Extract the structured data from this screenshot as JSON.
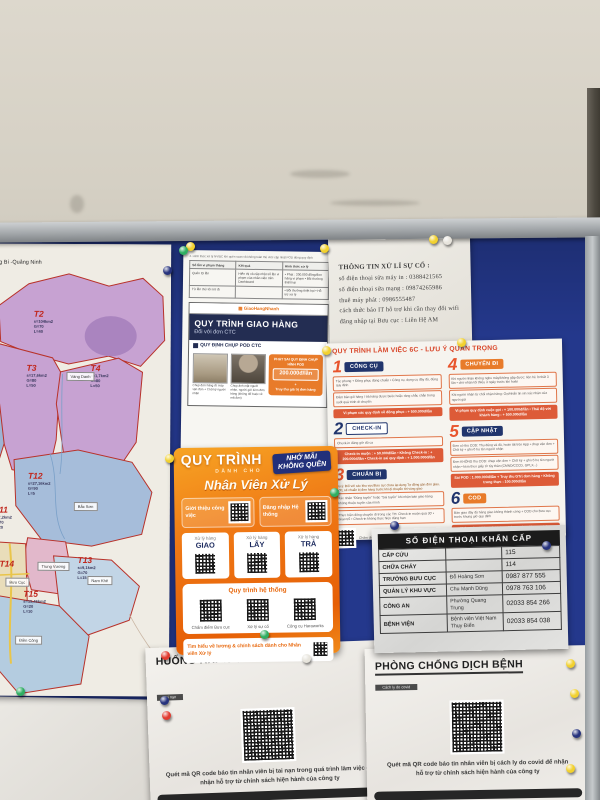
{
  "colors": {
    "board_blue": "#24388c",
    "wall": "#d8d3c8",
    "frame": "#b3b6b9",
    "poster_orange": "#ef7815",
    "navy": "#21356d",
    "penalty_red": "#dd5b38",
    "black_bar": "#1b1b1b"
  },
  "map": {
    "title": "ông Bí -Quảng Ninh",
    "regions": [
      {
        "name": "T2",
        "stats": [
          "s=104km2",
          "G=70",
          "L=40"
        ],
        "x": 43,
        "y": 66
      },
      {
        "name": "T3",
        "stats": [
          "s=17,6km2",
          "G=80",
          "L=50"
        ],
        "x": 36,
        "y": 120
      },
      {
        "name": "T4",
        "stats": [
          "s=1,7km2",
          "G=80",
          "L=50"
        ],
        "x": 100,
        "y": 120
      },
      {
        "name": "T12",
        "stats": [
          "s=27,16km2",
          "G=90",
          "L=5"
        ],
        "x": 38,
        "y": 228
      },
      {
        "name": "T11",
        "stats": [
          "s=7,2km2",
          "G=70",
          "L=20"
        ],
        "x": 4,
        "y": 262
      },
      {
        "name": "T14",
        "stats": [],
        "x": 10,
        "y": 316
      },
      {
        "name": "T13",
        "stats": [
          "s=9,1km2",
          "G=70",
          "L=15"
        ],
        "x": 88,
        "y": 312
      },
      {
        "name": "T15",
        "stats": [
          "s=15,46km2",
          "G=20",
          "L=10"
        ],
        "x": 34,
        "y": 346
      }
    ],
    "places": [
      {
        "name": "Vàng Danh",
        "x": 76,
        "y": 128
      },
      {
        "name": "Bắc Sơn",
        "x": 84,
        "y": 258
      },
      {
        "name": "Trung Vương",
        "x": 48,
        "y": 318
      },
      {
        "name": "Nam Khê",
        "x": 98,
        "y": 332
      },
      {
        "name": "Bưu Cục",
        "x": 16,
        "y": 334
      },
      {
        "name": "Điền Công",
        "x": 26,
        "y": 392
      }
    ]
  },
  "giao_hang": {
    "top_note": "4. Hình thức xử lý NV/BC khi quên scan và không tuân thủ việc cập nhật POD đúng quy định",
    "table": {
      "headers": [
        "Số lần vi phạm tháng",
        "Kết quả",
        "Hình thức xử lý"
      ],
      "rows": [
        [
          "Quên ID lần",
          "Hiển thị và cập nhật số lần vi phạm của nhân viên trên Dashboard",
          "• Phạt : 200.000 đồng/đơn hàng vi phạm • Bồi thường thiệt hại"
        ],
        [
          "Từ lần thứ tới trở đi",
          "",
          "• Bồi thường thiệt hại • Hỗ trợ xử lý"
        ]
      ]
    },
    "logo": "GiaoHangNhanh",
    "header_title": "QUY TRÌNH GIAO HÀNG",
    "header_sub": "Đối với đơn CTC",
    "section_title": "QUY ĐỊNH CHỤP POD CTC",
    "photo1_caption": "Chụp đơn hàng đi: Hộp vận đơn + Chữ ký người nhận",
    "photo2_caption": "Chụp ảnh mặt người nhận, người gửi kèm đơn hàng (không để buộc về mã đơn)",
    "fine_title": "PHẠT SAI QUY ĐỊNH CHỤP HÌNH POD",
    "fine_amount": "200.000đ/lần",
    "fine_plus": "+",
    "fine_extra": "Truy thu giá trị đơn hàng"
  },
  "su_co": {
    "lines": [
      "THÔNG TIN XỬ LÍ SỰ CỐ :",
      "số điện thoại sửa máy in : 0388421565",
      "số điện thoại sửa mạng : 09874265986",
      "thuê máy phát : 0986555487",
      "cách thức báo IT hỗ trợ khi cần thay đổi wifi",
      "đăng nhập tại Bưu cục : Liên Hệ AM"
    ]
  },
  "sixc": {
    "title": "QUY TRÌNH LÀM VIỆC 6C - LƯU Ý QUAN TRỌNG",
    "columns": [
      [
        {
          "num": "1",
          "num_color": "#e8542c",
          "label": "CÔNG CỤ",
          "label_bg": "#21356d",
          "label_color": "#ffffff",
          "boxes": [
            "Tác phong + Đồng phục đúng chuẩn • Công cụ, dụng cụ đầy đủ, đúng quy định",
            "Đảm bảo gói hàng / trả hàng được buộc hoặc ràng chắc chắn trong suốt quá trình di chuyển"
          ],
          "penalty": "Vi phạm các quy định về đồng phục : + 500.000đ/lần"
        },
        {
          "num": "2",
          "num_color": "#21356d",
          "label": "CHECK-IN",
          "label_bg": "#ffffff",
          "label_color": "#21356d",
          "boxes": [
            "Check-in đúng giờ đủ ca"
          ],
          "penalty": "Check-in muộn : + 50.000đ/lần • Không Check-in : + 200.000đ/lần • Check-in sai quy định : + 1.000.000đ/lần"
        },
        {
          "num": "3",
          "num_color": "#e8542c",
          "label": "CHUẨN BỊ",
          "label_bg": "#21356d",
          "label_color": "#ffffff",
          "note": "Lưu ý: Đối với các khu vực/Bưu cục chưa áp dụng Tự động gán đơn giao, NVXL sẽ chuẩn bị đơn hàng trước khi di chuyển tới vùng giao",
          "boxes": [
            "Xác nhận \"Đúng tuyến\" hoặc \"Sai tuyến\" khi nhận bàn giao hàng không thuộc tuyến của mình",
            "Thực hiện đóng chuyến đi trong các TH: Check-in muộn quá 30' • Giao trễ • Check-in không thực hiện đúng hạn"
          ],
          "penalty": null
        }
      ],
      [
        {
          "num": "4",
          "num_color": "#e8542c",
          "label": "CHUYỂN ĐI",
          "label_bg": "#e87b2a",
          "label_color": "#ffffff",
          "boxes": [
            "Khi người nhận không nghe máy/không gặp được: liên hệ ít nhất 3 lần • chờ nhận tối thiểu 3 ngày trước khi hoàn",
            "Khi người nhận từ chối nhận hàng: Gọi/nhắn tin xin xác nhận của người gửi"
          ],
          "penalty": "Vi phạm quy định cuộc gọi : + 100.000đ/lần • Thái độ với khách hàng : + 500.000đ/lần"
        },
        {
          "num": "5",
          "num_color": "#e8542c",
          "label": "CẬP NHẬT",
          "label_bg": "#21356d",
          "label_color": "#ffffff",
          "boxes": [
            "Đơn có thu COD: Thu đúng và đủ, hoàn tất trên App • chụp vận đơn + Chữ ký + ghi rõ họ tên người nhận",
            "Đơn KHÔNG thu COD: chụp vận đơn + Chữ ký + ghi rõ họ tên người nhận • kèm theo giấy tờ tùy thân (CMND/CCCD, GPLX...)"
          ],
          "penalty": "Sai POD : 1.000.000đ/lần + Truy thu GTrị đơn hàng • Không trung thực : 100.000đ/lần"
        },
        {
          "num": "6",
          "num_color": "#21356d",
          "label": "COD",
          "label_bg": "#e87b2a",
          "label_color": "#ffffff",
          "boxes": [
            "Bàn giao đầy đủ hàng giao không thành công + COD cho Bưu cục trước khung giờ quy định"
          ],
          "penalty": "Chậm nộp COD : Xử lý theo Nội quy lao động • Không nộp/chiếm dụng COD : Xử lý hình sự theo luật pháp"
        }
      ]
    ],
    "qr_caption": "Chấm điểm chất lượng dịch vụ Bưu cục và nhân viên",
    "footer": "Designed by Lưu Thanh - Văn Dung"
  },
  "poster": {
    "title": "QUY TRÌNH",
    "subtitle": "DÀNH CHO",
    "badge_line1": "NHỚ MÃI",
    "badge_line2": "KHÔNG QUÊN",
    "name": "Nhân Viên Xử Lý",
    "intro_boxes": [
      "Giới thiệu công việc",
      "Đăng nhập Hệ thống"
    ],
    "handle_boxes": [
      {
        "pre": "Xử lý hàng",
        "main": "GIAO"
      },
      {
        "pre": "Xử lý hàng",
        "main": "LẤY"
      },
      {
        "pre": "Xử lý hàng",
        "main": "TRẢ"
      }
    ],
    "panel_title": "Quy trình hệ thống",
    "panel_items": [
      "Chấm điểm Bưu cục",
      "Xử lý sự cố",
      "Công cụ Haraworks"
    ],
    "footer_text": "Tìm hiểu về lương & chính sách dành cho Nhân viên Xử lý"
  },
  "phone": {
    "title": "SỐ ĐIỆN THOẠI KHẨN CẤP",
    "rows": [
      [
        "CẤP CỨU",
        "",
        "115"
      ],
      [
        "CHỮA CHÁY",
        "",
        "114"
      ],
      [
        "TRƯỞNG BƯU CỤC",
        "Đỗ Hoàng Sơn",
        "0987 877 555"
      ],
      [
        "QUẢN LÝ KHU VỰC",
        "Chu Mạnh Dũng",
        "0978 763 106"
      ],
      [
        "CÔNG AN",
        "Phường Quang Trung",
        "02033 854 266"
      ],
      [
        "BỆNH VIỆN",
        "Bệnh viện Việt Nam Thụy Điển",
        "02033 854 038"
      ]
    ]
  },
  "emergency": {
    "title": "HUỐNG KHẨN CẤP",
    "tag": "Tai nạn",
    "caption": "Quét mã QR code báo tin nhân viên bị tai nạn trong quá trình làm việc để nhận hỗ trợ từ chính sách hiện hành của công ty"
  },
  "covid": {
    "title": "PHÒNG CHỐNG DỊCH BỆNH",
    "tag": "Cách ly do covid",
    "caption": "Quét mã QR code báo tin nhân viên bị cách ly do covid để nhận hỗ trợ từ chính sách hiện hành của công ty"
  },
  "pins": [
    {
      "color": "#f2d12e",
      "x": 186,
      "y": 242
    },
    {
      "color": "#2fae62",
      "x": 179,
      "y": 246
    },
    {
      "color": "#27337d",
      "x": 163,
      "y": 266
    },
    {
      "color": "#f2d12e",
      "x": 320,
      "y": 244
    },
    {
      "color": "#f2d12e",
      "x": 429,
      "y": 235
    },
    {
      "color": "#e7e4dc",
      "x": 443,
      "y": 236
    },
    {
      "color": "#f2d12e",
      "x": 457,
      "y": 338
    },
    {
      "color": "#f2d12e",
      "x": 322,
      "y": 346
    },
    {
      "color": "#2fae62",
      "x": 330,
      "y": 488
    },
    {
      "color": "#27337d",
      "x": 390,
      "y": 521
    },
    {
      "color": "#2fae62",
      "x": 260,
      "y": 630
    },
    {
      "color": "#f2d12e",
      "x": 165,
      "y": 454
    },
    {
      "color": "#27337d",
      "x": 542,
      "y": 541
    },
    {
      "color": "#e23b30",
      "x": 161,
      "y": 651
    },
    {
      "color": "#e7e4dc",
      "x": 302,
      "y": 654
    },
    {
      "color": "#27337d",
      "x": 160,
      "y": 696
    },
    {
      "color": "#e23b30",
      "x": 162,
      "y": 711
    },
    {
      "color": "#2fae62",
      "x": 16,
      "y": 687
    },
    {
      "color": "#f2d12e",
      "x": 566,
      "y": 659
    },
    {
      "color": "#f2d12e",
      "x": 570,
      "y": 689
    },
    {
      "color": "#27337d",
      "x": 572,
      "y": 729
    },
    {
      "color": "#f2d12e",
      "x": 566,
      "y": 764
    }
  ]
}
